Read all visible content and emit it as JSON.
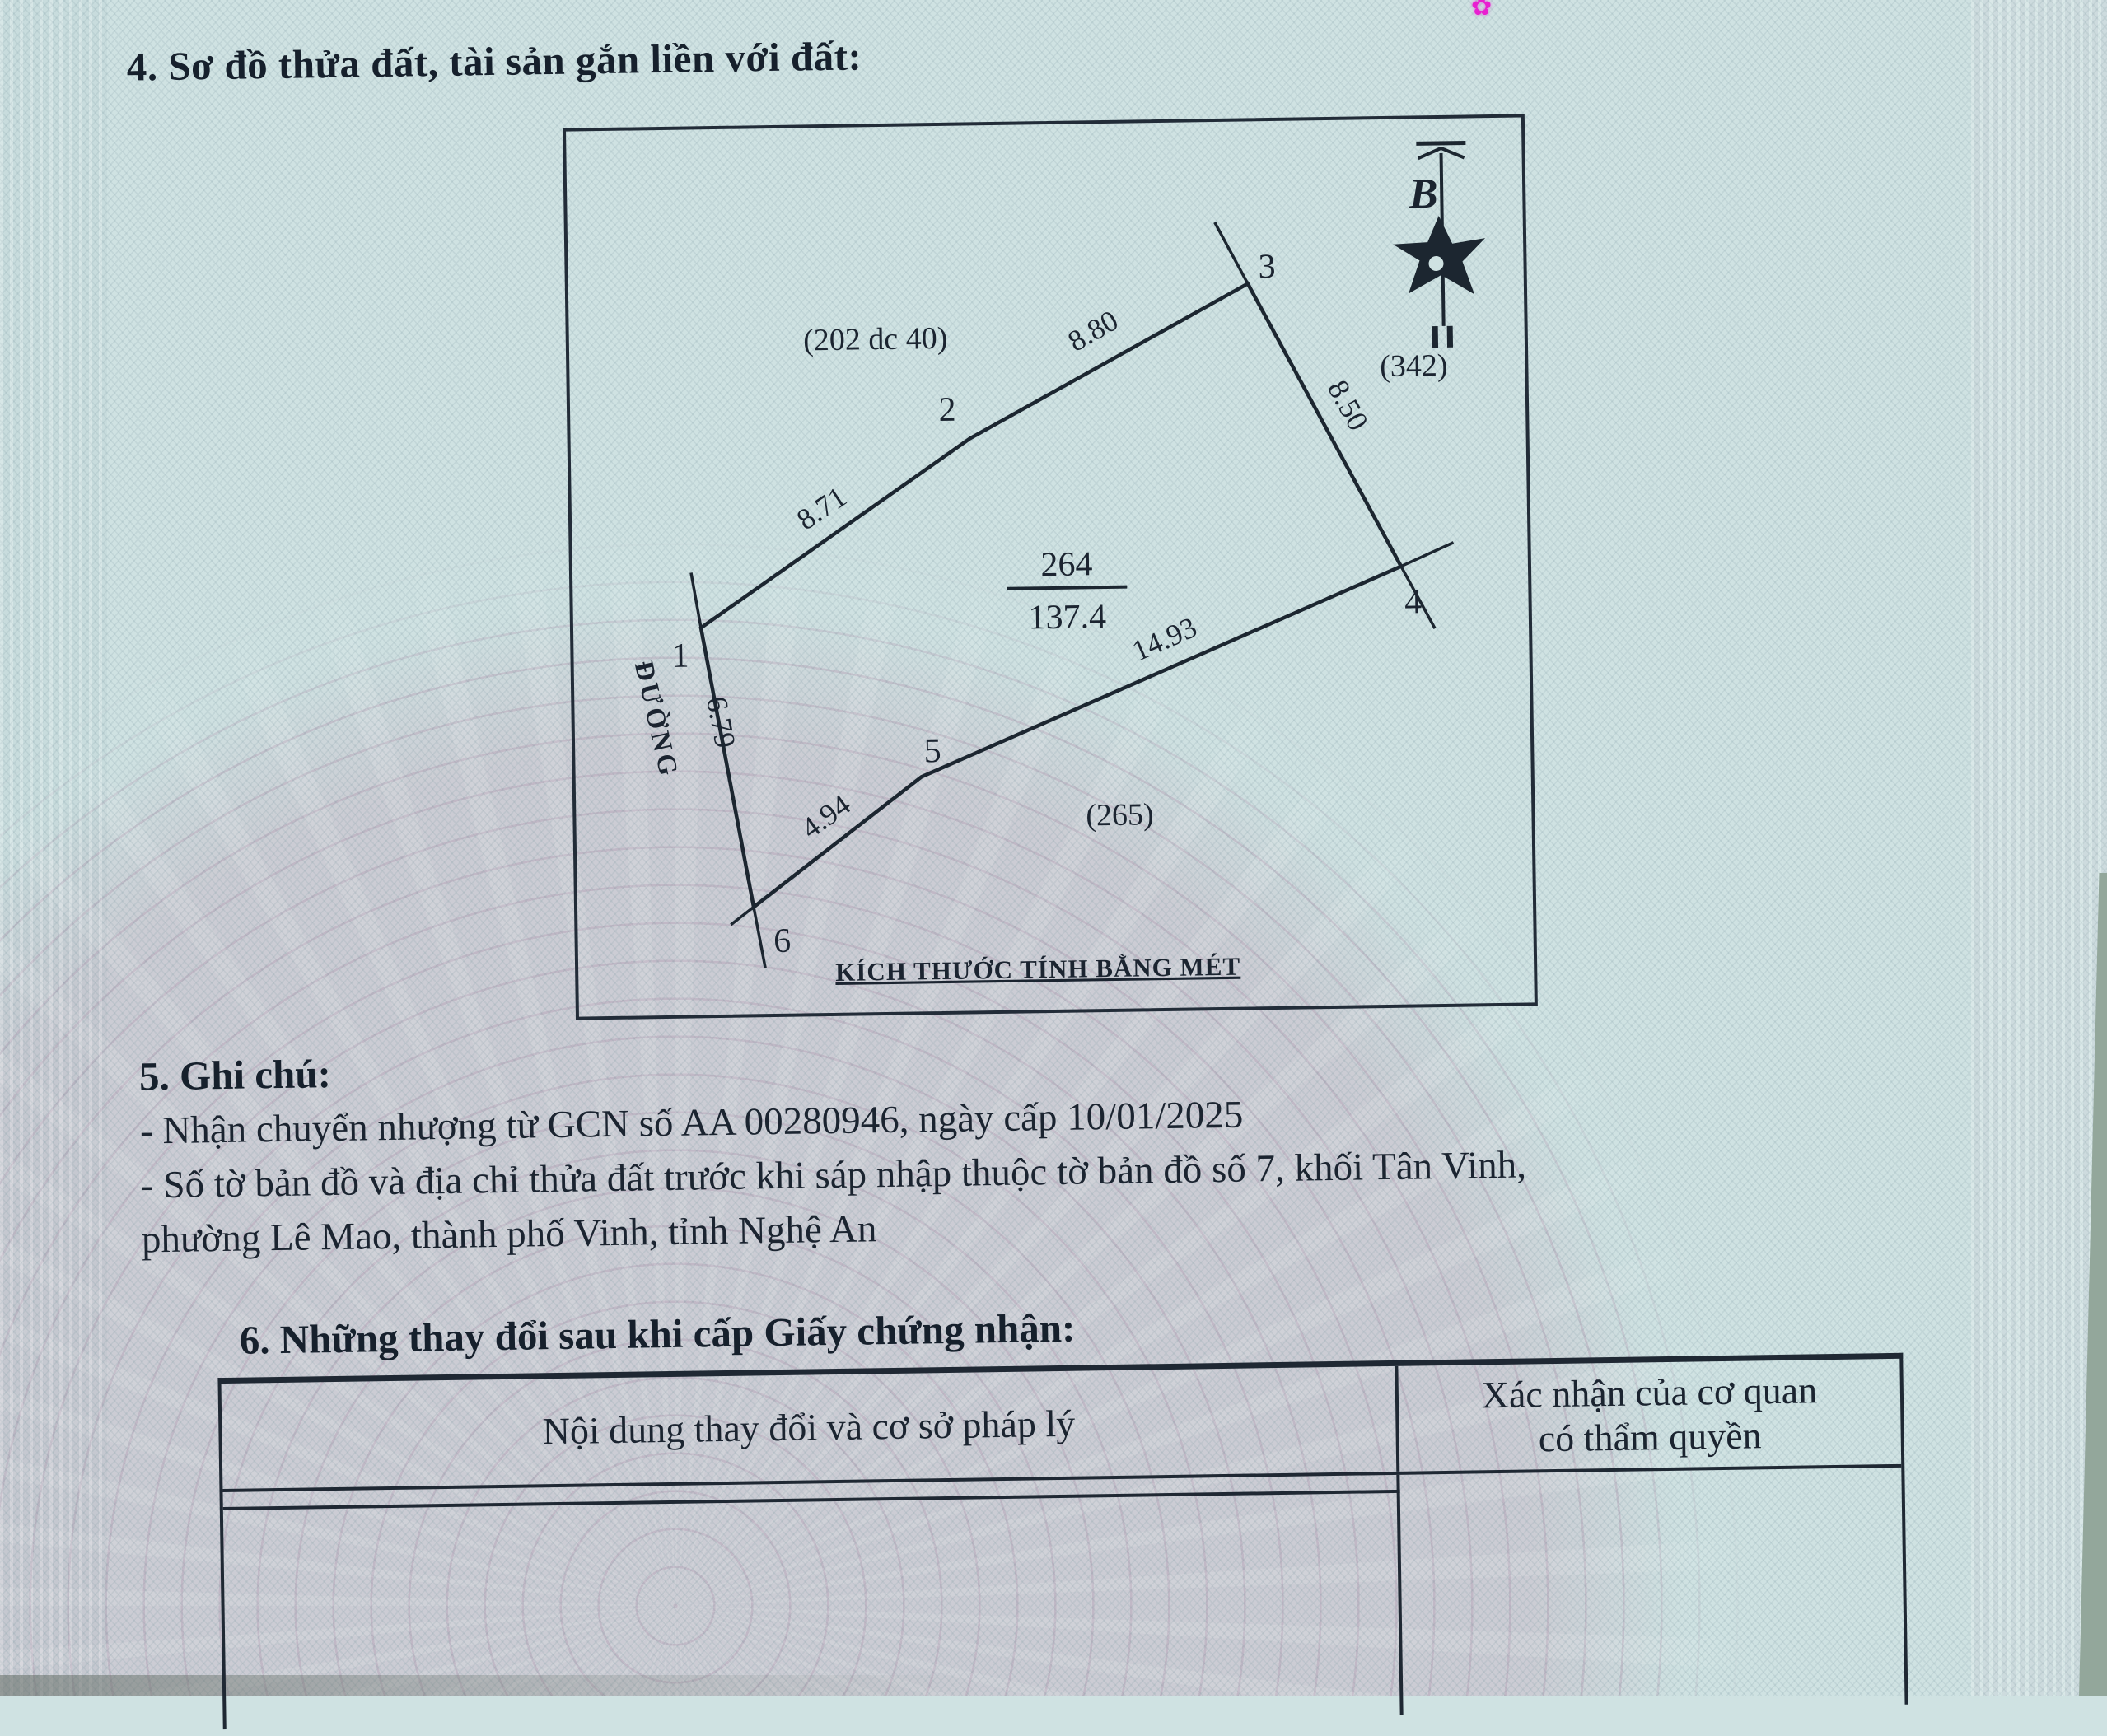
{
  "document": {
    "section4_title": "4. Sơ đồ thửa đất, tài sản gắn liền với đất:",
    "section5": {
      "title": "5. Ghi chú:",
      "lines": [
        "- Nhận chuyển nhượng từ GCN số AA 00280946, ngày cấp 10/01/2025",
        "- Số tờ bản đồ và địa chỉ thửa đất trước khi sáp nhập thuộc tờ bản đồ số 7, khối Tân Vinh,",
        "phường Lê Mao, thành phố Vinh, tỉnh Nghệ An"
      ]
    },
    "section6": {
      "title": "6. Những thay đổi sau khi cấp Giấy chứng nhận:",
      "table": {
        "col1_header": "Nội dung thay đổi và cơ sở pháp lý",
        "col2_header_line1": "Xác nhận của cơ quan",
        "col2_header_line2": "có thẩm quyền"
      }
    }
  },
  "diagram": {
    "parcel_number": "264",
    "parcel_area": "137.4",
    "footer_note": "KÍCH THƯỚC TÍNH BẰNG MÉT",
    "road_label": "ĐƯỜNG",
    "north_label": "B",
    "vertices": [
      "1",
      "2",
      "3",
      "4",
      "5",
      "6"
    ],
    "edges": [
      {
        "between": "1-2",
        "length": "8.71"
      },
      {
        "between": "2-3",
        "length": "8.80"
      },
      {
        "between": "3-4",
        "length": "8.50"
      },
      {
        "between": "4-5",
        "length": "14.93"
      },
      {
        "between": "5-6",
        "length": "4.94"
      },
      {
        "between": "6-1",
        "length": "6.79"
      }
    ],
    "adjacent_parcels": [
      "(202 dc 40)",
      "(342)",
      "(265)"
    ]
  }
}
